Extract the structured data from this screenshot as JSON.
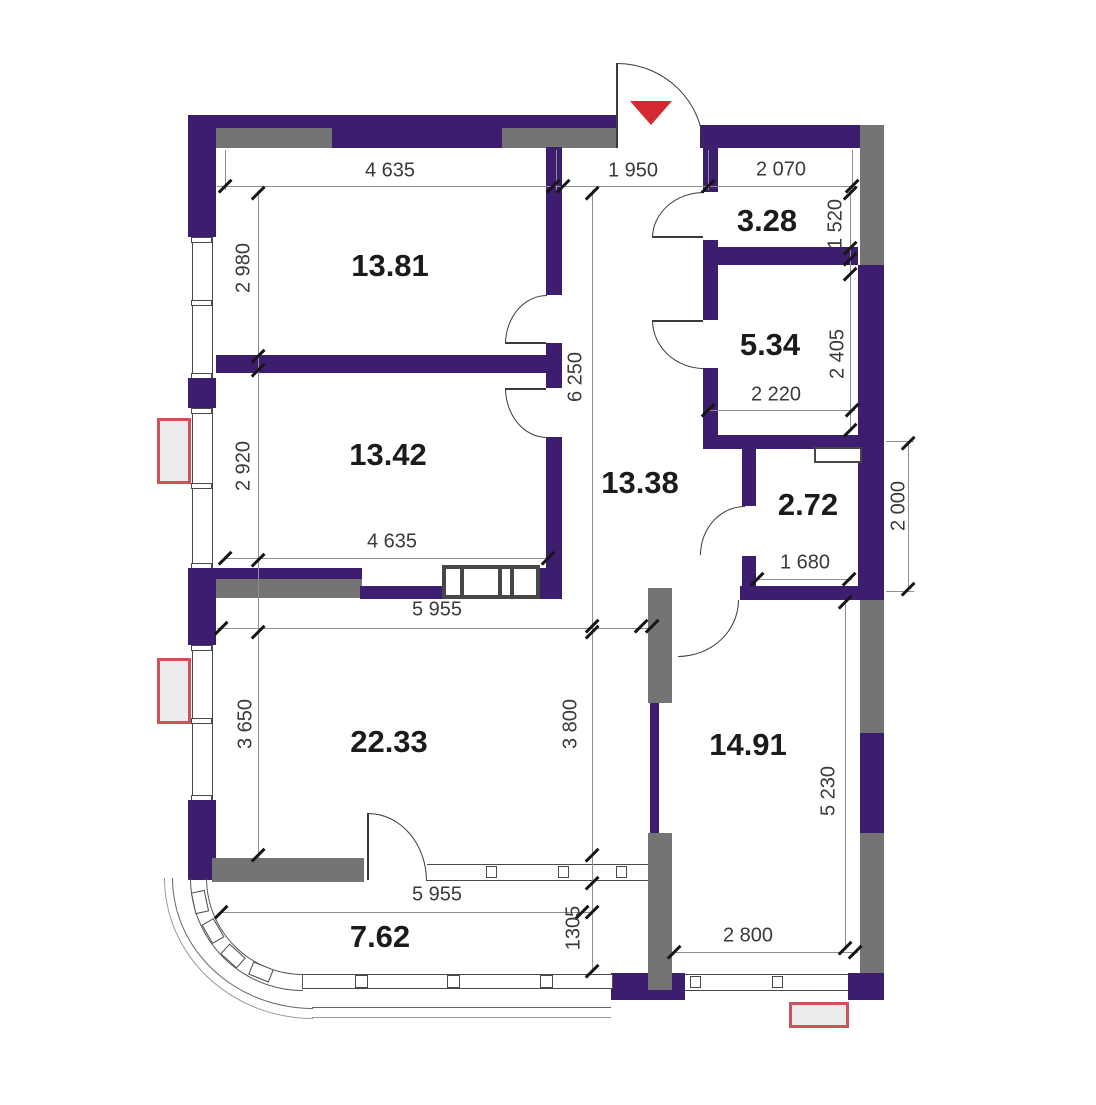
{
  "plan": {
    "title": "apartment floor plan",
    "rooms": [
      {
        "id": "room-top-left",
        "area": "13.81"
      },
      {
        "id": "room-mid-left",
        "area": "13.42"
      },
      {
        "id": "hallway",
        "area": "13.38"
      },
      {
        "id": "wc-small",
        "area": "3.28"
      },
      {
        "id": "bathroom",
        "area": "5.34"
      },
      {
        "id": "storage",
        "area": "2.72"
      },
      {
        "id": "living-room",
        "area": "22.33"
      },
      {
        "id": "room-bottom-right",
        "area": "14.91"
      },
      {
        "id": "balcony",
        "area": "7.62"
      }
    ],
    "dimensions": {
      "top_4635": "4 635",
      "top_1950": "1 950",
      "top_2070": "2 070",
      "v_2980": "2 980",
      "v_2920": "2 920",
      "b_4635": "4 635",
      "v_6250": "6 250",
      "v_1520": "1 520",
      "v_2405": "2 405",
      "w_2220": "2 220",
      "w_1680": "1 680",
      "ext_2000": "2 000",
      "t_5955": "5 955",
      "v_3650": "3 650",
      "v_3800": "3 800",
      "v_5230": "5 230",
      "b_2800": "2 800",
      "bb_5955": "5 955",
      "v_1305": "1305"
    },
    "colors": {
      "wall": "#3d1d6e",
      "gray": "#747474",
      "red": "#d42931",
      "ac_border": "#c9545c"
    }
  }
}
